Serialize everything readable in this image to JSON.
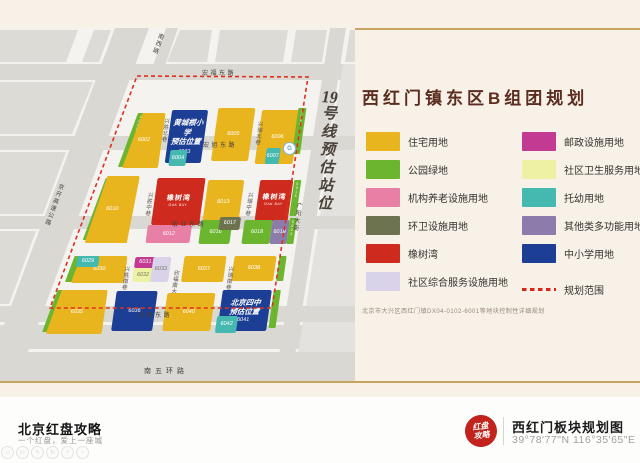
{
  "map": {
    "roads": {
      "hongfu": "宏福东路",
      "hongxu": "宏旭东路",
      "hongye": "宏业东路",
      "hongkang": "宏康东路",
      "wuhuan": "南五环路",
      "jingkai": "京开高速公路",
      "nanxi": "南西路",
      "guangyang": "广阳大街",
      "lane_xingsheng_bei": "兴胜北巷",
      "lane_xingrui_bei": "兴瑞北巷",
      "lane_xingsheng_zhong": "兴胜中巷",
      "lane_xingrui_zhong": "兴瑞中巷",
      "lane_xingsheng_nan": "兴胜南巷",
      "lane_xingrui_nan": "兴瑞南巷",
      "xinfu": "欣福南大街"
    },
    "subway": {
      "num": "19",
      "chars": "号线预估站位",
      "icon": "metro-station-icon"
    },
    "ids": {
      "6001": "6001",
      "6002": "6002",
      "6003": "6003",
      "6004": "6004",
      "6005": "6005",
      "6006": "6006",
      "6007": "6007",
      "6008": "6008",
      "6010": "6010",
      "6012": "6012",
      "6013": "6013",
      "6015": "6015",
      "6016": "6016",
      "6017": "6017",
      "6018": "6018",
      "6019": "6019",
      "6022": "6022",
      "6029": "6029",
      "6030": "6030",
      "6031": "6031",
      "6032": "6032",
      "6033": "6033",
      "6035": "6035",
      "6036": "6036",
      "6037": "6037",
      "6038": "6038",
      "6040": "6040",
      "6041": "6041",
      "6042": "6042"
    },
    "oak": {
      "cn": "橡树湾",
      "en": "OAK BAY"
    },
    "schools": {
      "s6003": {
        "l1": "黄城根小学",
        "l2": "预估位置"
      },
      "s6041": {
        "l1": "北京四中",
        "l2": "预估位置"
      }
    }
  },
  "legend": {
    "title": "西红门镇东区B组团规划",
    "items_left": [
      {
        "label": "住宅用地",
        "color": "#E9B51F"
      },
      {
        "label": "公园绿地",
        "color": "#6CB52F"
      },
      {
        "label": "机构养老设施用地",
        "color": "#E87FA5"
      },
      {
        "label": "环卫设施用地",
        "color": "#6D724F"
      },
      {
        "label": "橡树湾",
        "color": "#CE2A1D"
      },
      {
        "label": "社区综合服务设施用地",
        "color": "#D9D3EA"
      }
    ],
    "items_right": [
      {
        "label": "邮政设施用地",
        "color": "#C23A92"
      },
      {
        "label": "社区卫生服务用地",
        "color": "#EDF1A4"
      },
      {
        "label": "托幼用地",
        "color": "#45B8B0"
      },
      {
        "label": "其他类多功能用地",
        "color": "#8B7CAC"
      },
      {
        "label": "中小学用地",
        "color": "#1C3E94"
      }
    ],
    "boundary_label": "规划范围",
    "boundary_color": "#D8251C",
    "note": "北京市大兴区西红门镇DX04-0102-6001等地块控制性详细规划"
  },
  "footer": {
    "brand_title": "北京红盘攻略",
    "brand_tagline": "一个红盘，爱上一座城",
    "seal_l1": "红盘",
    "seal_l2": "攻略",
    "doc_title": "西红门板块规划图",
    "coords": "39°78'77\"N 116°35'65\"E"
  },
  "toolbar": {
    "icons": [
      {
        "name": "back-icon",
        "glyph": "◁"
      },
      {
        "name": "forward-icon",
        "glyph": "▷"
      },
      {
        "name": "edit-icon",
        "glyph": "✎"
      },
      {
        "name": "refresh-icon",
        "glyph": "↻"
      },
      {
        "name": "search-icon",
        "glyph": "⌕"
      },
      {
        "name": "minus-icon",
        "glyph": "−"
      }
    ]
  }
}
